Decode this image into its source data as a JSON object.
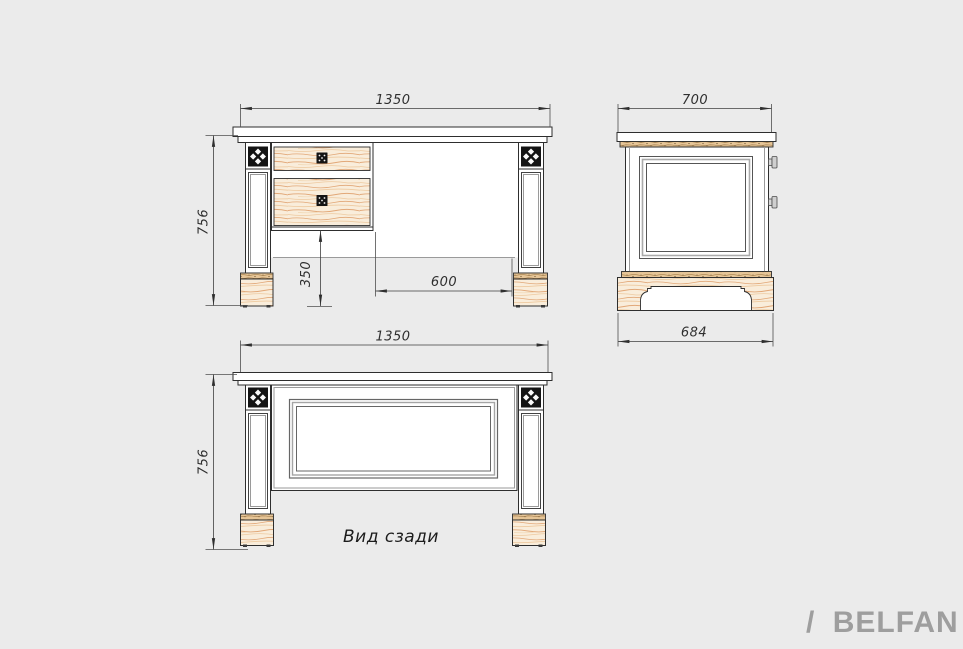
{
  "page": {
    "background": "#ebebeb"
  },
  "drawing": {
    "front_view": {
      "width_label": "1350",
      "height_label": "756",
      "leg_height_label": "350",
      "kneehole_width_label": "600"
    },
    "side_view": {
      "width_label": "700",
      "base_width_label": "684"
    },
    "back_view": {
      "width_label": "1350",
      "height_label": "756",
      "caption": "Вид сзади"
    },
    "colors": {
      "line": "#2e2e2e",
      "dimension": "#3f3f3f",
      "wood_fill": "#f9eddb",
      "wood_grain": "#e2a878",
      "wood_cap": "#e6c597",
      "rosette": "#141414"
    }
  },
  "brand": {
    "slash": "/",
    "name": "BELFAN",
    "color": "#9e9e9e"
  }
}
